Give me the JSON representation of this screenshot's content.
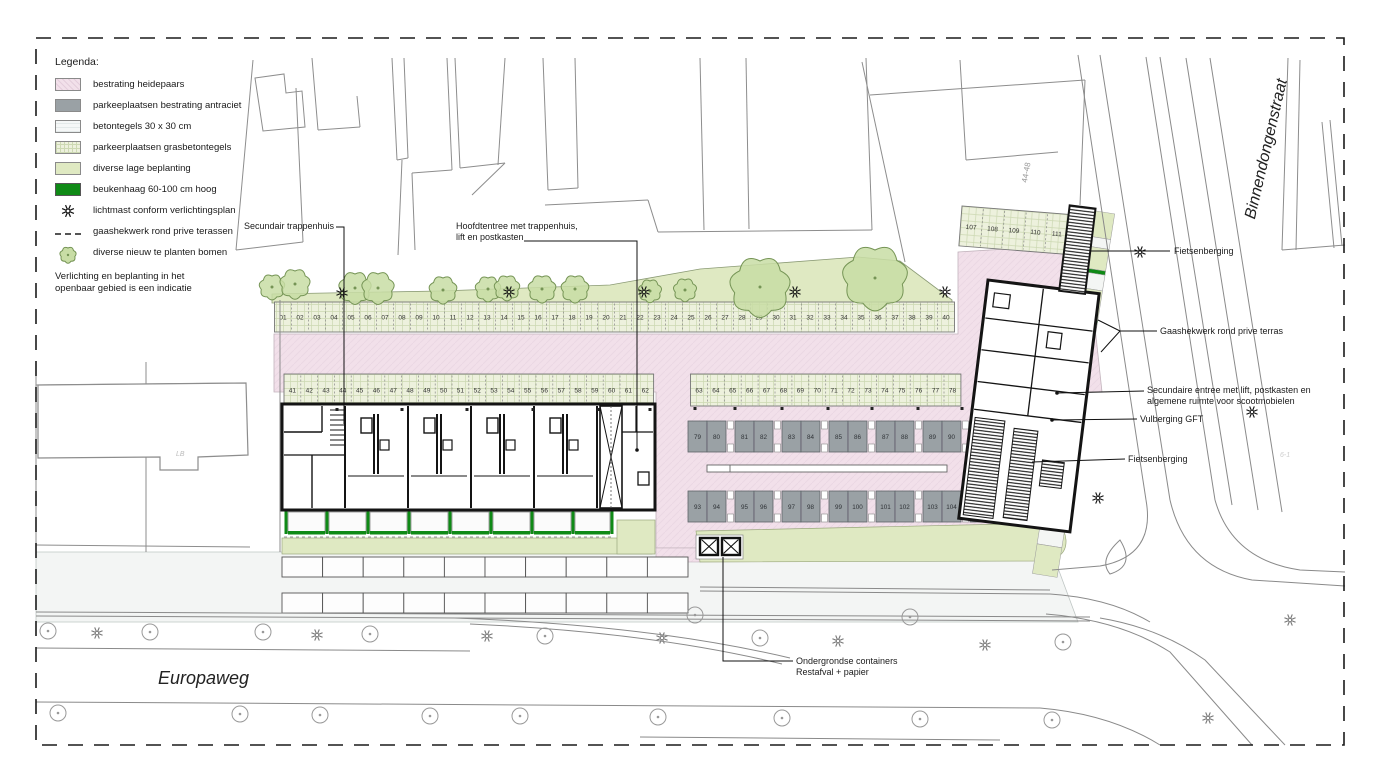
{
  "legend": {
    "title": "Legenda:",
    "items": [
      {
        "type": "pink",
        "label": "bestrating heidepaars"
      },
      {
        "type": "gray",
        "label": "parkeeplaatsen bestrating antraciet"
      },
      {
        "type": "tile",
        "label": "betontegels 30 x 30 cm"
      },
      {
        "type": "grass",
        "label": "parkeerplaatsen grasbetontegels"
      },
      {
        "type": "plant",
        "label": "diverse lage beplanting"
      },
      {
        "type": "hedge",
        "label": "beukenhaag 60-100 cm hoog"
      },
      {
        "type": "star",
        "label": "lichtmast conform verlichtingsplan"
      },
      {
        "type": "dash",
        "label": "gaashekwerk rond prive terassen"
      },
      {
        "type": "tree",
        "label": "diverse nieuw te planten bomen"
      }
    ],
    "note": "Verlichting en beplanting in het\nopenbaar gebied is een indicatie"
  },
  "streets": {
    "europaweg": "Europaweg",
    "binnendongenstraat": "Binnendongenstraat"
  },
  "annotations": {
    "secundair": "Secundair trappenhuis",
    "hoofdentree": "Hoofdtentree met trappenhuis,\nlift en postkasten",
    "fietsenberging_top": "Fietsenberging",
    "gaashekwerk": "Gaashekwerk rond prive terras",
    "secundaire_entree": "Secundaire entree met lift, postkasten en\nalgemene ruimte voor scootmobielen",
    "vulberging": "Vulberging GFT",
    "fietsenberging_bottom": "Fietsenberging",
    "containers": "Ondergrondse containers\nRestafval + papier"
  },
  "labels": {
    "building_number": "44-48",
    "lb": "LB",
    "faint": "6-1"
  },
  "parking": {
    "row_top": [
      "01",
      "02",
      "03",
      "04",
      "05",
      "06",
      "07",
      "08",
      "09",
      "10",
      "11",
      "12",
      "13",
      "14",
      "15",
      "16",
      "17",
      "18",
      "19",
      "20",
      "21",
      "22",
      "23",
      "24",
      "25",
      "26",
      "27",
      "28",
      "29",
      "30",
      "31",
      "32",
      "33",
      "34",
      "35",
      "36",
      "37",
      "38",
      "39",
      "40"
    ],
    "row_mid_west": [
      "41",
      "42",
      "43",
      "44",
      "45",
      "46",
      "47",
      "48",
      "49",
      "50",
      "51",
      "52",
      "53",
      "54",
      "55",
      "56",
      "57",
      "58",
      "59",
      "60",
      "61",
      "62"
    ],
    "row_mid_east": [
      "63",
      "64",
      "65",
      "66",
      "67",
      "68",
      "69",
      "70",
      "71",
      "72",
      "73",
      "74",
      "75",
      "76",
      "77",
      "78"
    ],
    "yard_north": [
      "79",
      "80",
      "81",
      "82",
      "83",
      "84",
      "85",
      "86",
      "87",
      "88",
      "89",
      "90",
      "91",
      "92"
    ],
    "yard_south": [
      "93",
      "94",
      "95",
      "96",
      "97",
      "98",
      "99",
      "100",
      "101",
      "102",
      "103",
      "104",
      "105",
      "106"
    ],
    "corner": [
      "107",
      "108",
      "109",
      "110",
      "111",
      "112"
    ]
  },
  "colors": {
    "paving_pink": "#f2e0ea",
    "antraciet": "#9aa1a5",
    "betontegels": "#f3f5f4",
    "grasbeton": "#edf1dd",
    "planting": "#dfe9c2",
    "hedge": "#0f8a16",
    "wall": "#141414",
    "parcel_line": "#8d8d8d"
  }
}
